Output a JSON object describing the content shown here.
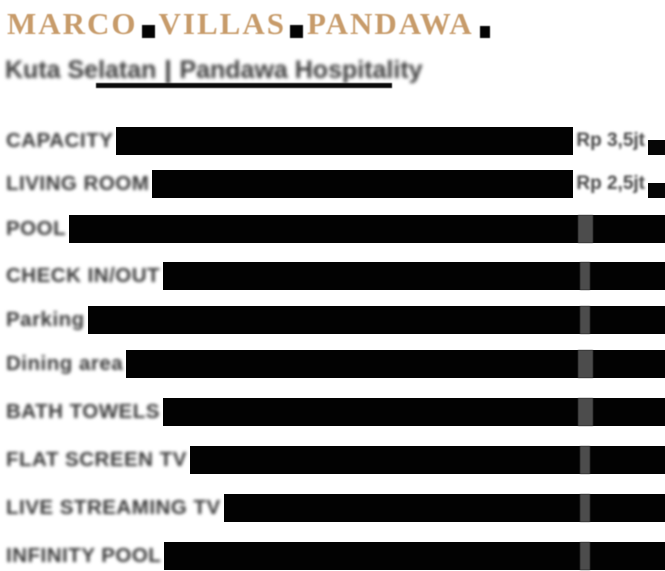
{
  "colors": {
    "title_gold": "#c49a6b",
    "label_gray": "#454545",
    "bar_black": "#020202",
    "value_gray": "#4f4f4f",
    "background": "#ffffff"
  },
  "header": {
    "title": "MARCO VILLAS PANDAWA",
    "title_words": [
      "MARCO",
      "VILLAS",
      "PANDAWA"
    ],
    "subtitle": {
      "left": "Kuta Selatan",
      "separator": "|",
      "right": "Pandawa Hospitality"
    }
  },
  "list": {
    "rows": [
      {
        "label": "CAPACITY",
        "value": "Rp 3,5jt"
      },
      {
        "label": "LIVING ROOM",
        "value": "Rp 2,5jt"
      },
      {
        "label": "POOL",
        "value": ""
      },
      {
        "label": "CHECK IN/OUT",
        "value": ""
      },
      {
        "label": "Parking",
        "value": ""
      },
      {
        "label": "Dining area",
        "value": ""
      },
      {
        "label": "BATH TOWELS",
        "value": ""
      },
      {
        "label": "FLAT SCREEN TV",
        "value": ""
      },
      {
        "label": "LIVE STREAMING TV",
        "value": ""
      },
      {
        "label": "INFINITY POOL",
        "value": ""
      }
    ]
  }
}
